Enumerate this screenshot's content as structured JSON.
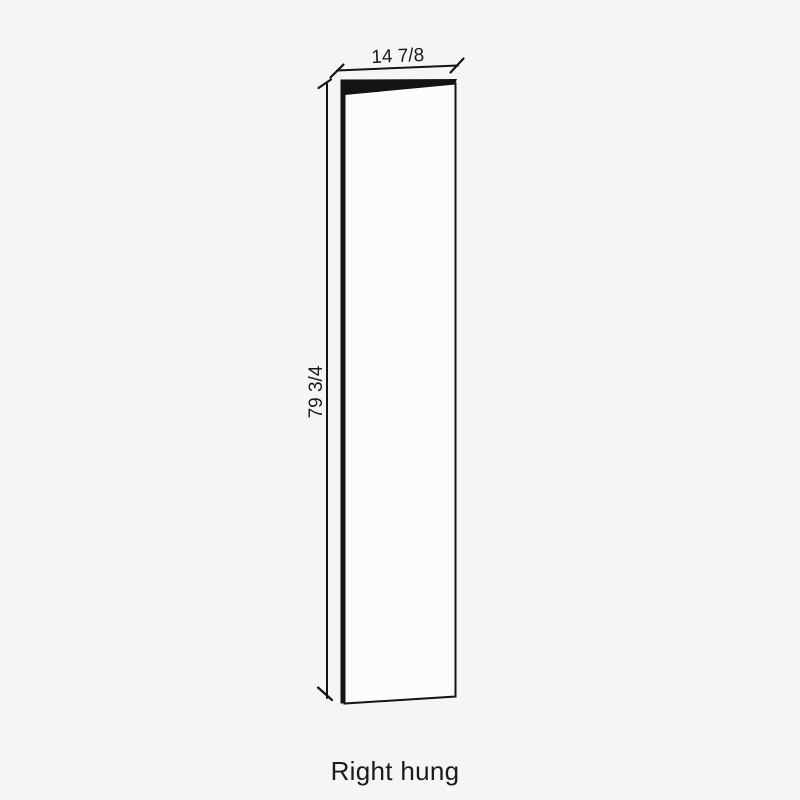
{
  "diagram": {
    "caption": "Right hung",
    "width_dimension": "14 7/8",
    "height_dimension": "79 3/4",
    "colors": {
      "background": "#f5f5f6",
      "line": "#141414",
      "door_face": "#fcfcfc",
      "text": "#1a1a1a"
    }
  }
}
